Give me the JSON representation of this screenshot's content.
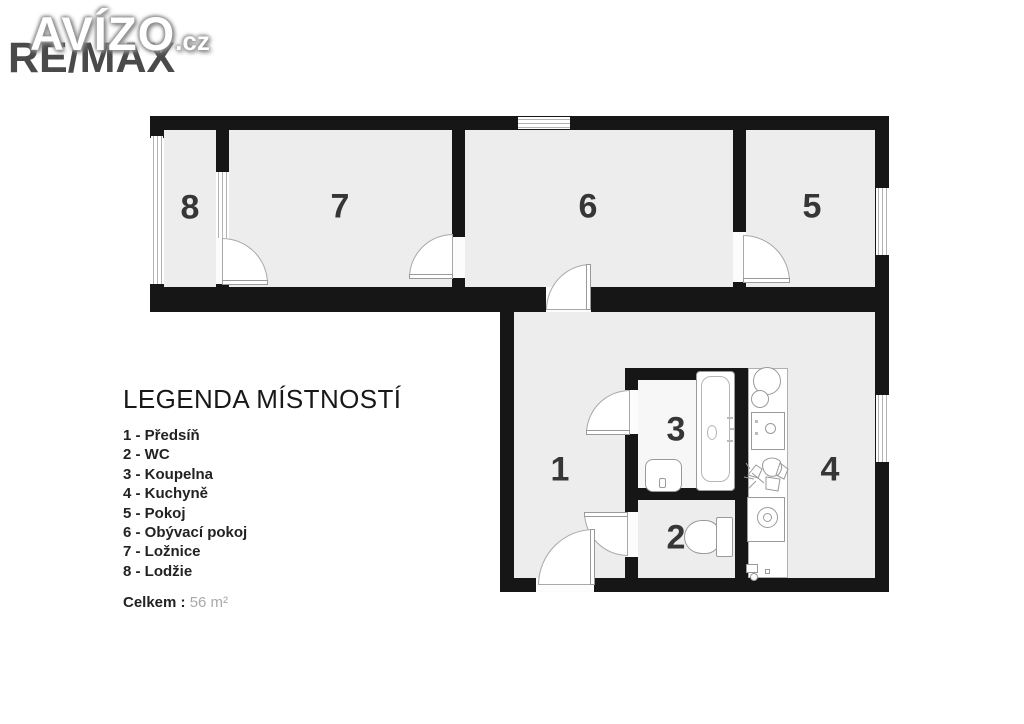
{
  "logo": {
    "brand_primary": "AVÍZO",
    "brand_primary_tld": ".cz",
    "brand_secondary": "RE/MAX"
  },
  "legend": {
    "title": "LEGENDA MÍSTNOSTÍ",
    "items": [
      "1 - Předsíň",
      "2 - WC",
      "3 - Koupelna",
      "4 - Kuchyně",
      "5 - Pokoj",
      "6 - Obývací pokoj",
      "7 - Ložnice",
      "8 - Lodžie"
    ],
    "total_label": "Celkem :",
    "total_value": "56 m²"
  },
  "floorplan": {
    "rooms": [
      {
        "number": "1",
        "name": "Předsíň"
      },
      {
        "number": "2",
        "name": "WC"
      },
      {
        "number": "3",
        "name": "Koupelna"
      },
      {
        "number": "4",
        "name": "Kuchyně"
      },
      {
        "number": "5",
        "name": "Pokoj"
      },
      {
        "number": "6",
        "name": "Obývací pokoj"
      },
      {
        "number": "7",
        "name": "Ložnice"
      },
      {
        "number": "8",
        "name": "Lodžie"
      }
    ],
    "total_area": "56 m²"
  },
  "colors": {
    "wall": "#161616",
    "room_fill": "#ededed",
    "bathroom_fill": "#f7f7f7",
    "fixture_line": "#9a9a9a",
    "accent_text": "#363636"
  }
}
